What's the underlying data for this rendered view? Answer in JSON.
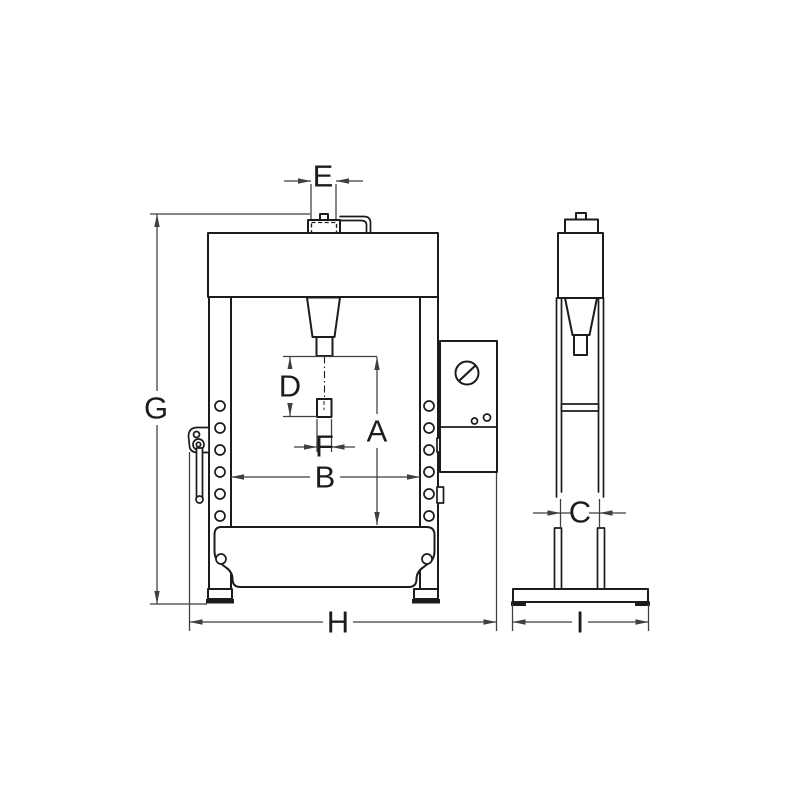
{
  "drawing": {
    "dimension_labels": {
      "A": "A",
      "B": "B",
      "C": "C",
      "D": "D",
      "E": "E",
      "F": "F",
      "G": "G",
      "H": "H",
      "I": "I"
    },
    "icons": {
      "gauge": "pressure-gauge-icon"
    },
    "colors": {
      "bg": "#ffffff",
      "part": "#1c1c1c",
      "dim": "#3f3f3f"
    }
  }
}
